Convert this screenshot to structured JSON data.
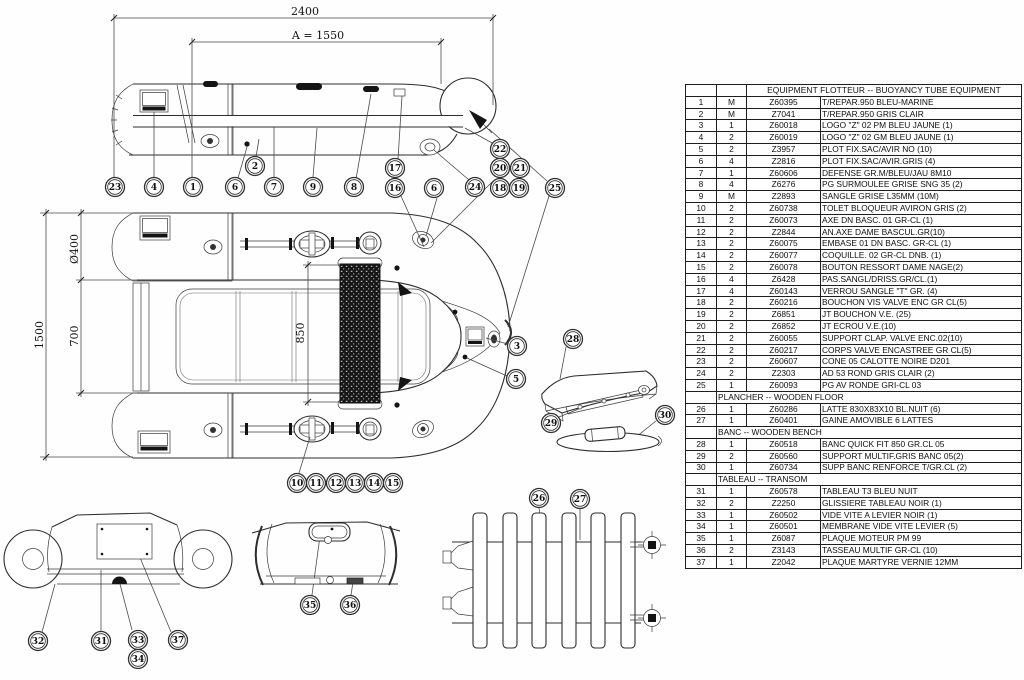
{
  "table": {
    "group_header": "EQUIPMENT FLOTTEUR -- BUOYANCY TUBE EQUIPMENT",
    "rows": [
      {
        "no": "1",
        "qty": "M",
        "ref": "Z60395",
        "desc": "T/REPAR.950 BLEU-MARINE"
      },
      {
        "no": "2",
        "qty": "M",
        "ref": "Z7041",
        "desc": "T/REPAR.950 GRIS CLAIR"
      },
      {
        "no": "3",
        "qty": "1",
        "ref": "Z60018",
        "desc": "LOGO \"Z\" 02 PM BLEU JAUNE (1)"
      },
      {
        "no": "4",
        "qty": "2",
        "ref": "Z60019",
        "desc": "LOGO \"Z\" 02 GM BLEU JAUNE (1)"
      },
      {
        "no": "5",
        "qty": "2",
        "ref": "Z3957",
        "desc": "PLOT FIX.SAC/AVIR NO (10)"
      },
      {
        "no": "6",
        "qty": "4",
        "ref": "Z2816",
        "desc": "PLOT FIX.SAC/AVIR.GRIS (4)"
      },
      {
        "no": "7",
        "qty": "1",
        "ref": "Z60606",
        "desc": "DEFENSE GR.M/BLEU/JAU 8M10"
      },
      {
        "no": "8",
        "qty": "4",
        "ref": "Z6276",
        "desc": "PG SURMOULEE GRISE SNG 35 (2)"
      },
      {
        "no": "9",
        "qty": "M",
        "ref": "Z2893",
        "desc": "SANGLE GRISE L35MM (10M)"
      },
      {
        "no": "10",
        "qty": "2",
        "ref": "Z60738",
        "desc": "TOLET BLOQUEUR AVIRON GRIS (2)"
      },
      {
        "no": "11",
        "qty": "2",
        "ref": "Z60073",
        "desc": "AXE DN BASC. 01 GR-CL (1)"
      },
      {
        "no": "12",
        "qty": "2",
        "ref": "Z2844",
        "desc": "AN.AXE DAME BASCUL.GR(10)"
      },
      {
        "no": "13",
        "qty": "2",
        "ref": "Z60075",
        "desc": "EMBASE 01 DN BASC. GR-CL (1)"
      },
      {
        "no": "14",
        "qty": "2",
        "ref": "Z60077",
        "desc": "COQUILLE. 02 GR-CL DNB. (1)"
      },
      {
        "no": "15",
        "qty": "2",
        "ref": "Z60078",
        "desc": "BOUTON RESSORT DAME NAGE(2)"
      },
      {
        "no": "16",
        "qty": "4",
        "ref": "Z6428",
        "desc": "PAS.SANGL/DRISS.GR/CL.(1)"
      },
      {
        "no": "17",
        "qty": "4",
        "ref": "Z60143",
        "desc": "VERROU SANGLE \"T\" GR. (4)"
      },
      {
        "no": "18",
        "qty": "2",
        "ref": "Z60216",
        "desc": "BOUCHON VIS VALVE ENC GR CL(5)"
      },
      {
        "no": "19",
        "qty": "2",
        "ref": "Z6851",
        "desc": "JT BOUCHON V.E. (25)"
      },
      {
        "no": "20",
        "qty": "2",
        "ref": "Z6852",
        "desc": "JT ECROU V.E.(10)"
      },
      {
        "no": "21",
        "qty": "2",
        "ref": "Z60055",
        "desc": "SUPPORT CLAP. VALVE ENC.02(10)"
      },
      {
        "no": "22",
        "qty": "2",
        "ref": "Z60217",
        "desc": "CORPS VALVE ENCASTREE GR CL(5)"
      },
      {
        "no": "23",
        "qty": "2",
        "ref": "Z60607",
        "desc": "CONE 05 CALOTTE NOIRE D201"
      },
      {
        "no": "24",
        "qty": "2",
        "ref": "Z2303",
        "desc": "AD 53 ROND GRIS CLAIR (2)"
      },
      {
        "no": "25",
        "qty": "1",
        "ref": "Z60093",
        "desc": "PG AV RONDE GRI-CL 03"
      },
      {
        "section": "PLANCHER -- WOODEN FLOOR"
      },
      {
        "no": "26",
        "qty": "1",
        "ref": "Z60286",
        "desc": "LATTE 830X83X10 BL.NUIT (6)"
      },
      {
        "no": "27",
        "qty": "1",
        "ref": "Z60401",
        "desc": "GAINE AMOVIBLE 6 LATTES"
      },
      {
        "section": "BANC -- WOODEN BENCH"
      },
      {
        "no": "28",
        "qty": "1",
        "ref": "Z60518",
        "desc": "BANC QUICK FIT 850 GR.CL 05"
      },
      {
        "no": "29",
        "qty": "2",
        "ref": "Z60560",
        "desc": "SUPPORT MULTIF.GRIS BANC 05(2)"
      },
      {
        "no": "30",
        "qty": "1",
        "ref": "Z60734",
        "desc": "SUPP BANC RENFORCE T/GR.CL (2)"
      },
      {
        "section": "TABLEAU -- TRANSOM"
      },
      {
        "no": "31",
        "qty": "1",
        "ref": "Z60578",
        "desc": "TABLEAU T3 BLEU NUIT"
      },
      {
        "no": "32",
        "qty": "2",
        "ref": "Z2250",
        "desc": "GLISSIERE TABLEAU NOIR (1)"
      },
      {
        "no": "33",
        "qty": "1",
        "ref": "Z60502",
        "desc": "VIDE VITE A LEVIER NOIR (1)"
      },
      {
        "no": "34",
        "qty": "1",
        "ref": "Z60501",
        "desc": "MEMBRANE VIDE VITE LEVIER (5)"
      },
      {
        "no": "35",
        "qty": "1",
        "ref": "Z6087",
        "desc": "PLAQUE MOTEUR PM 99"
      },
      {
        "no": "36",
        "qty": "2",
        "ref": "Z3143",
        "desc": "TASSEAU MULTIF GR-CL (10)"
      },
      {
        "no": "37",
        "qty": "1",
        "ref": "Z2042",
        "desc": "PLAQUE MARTYRE VERNIE 12MM"
      }
    ]
  },
  "dimensions": [
    {
      "label": "2400",
      "x": 305,
      "y": 15,
      "rotate": false
    },
    {
      "label": "A = 1550",
      "x": 318,
      "y": 39,
      "rotate": false
    },
    {
      "label": "1500",
      "x": 43,
      "y": 335,
      "rotate": true
    },
    {
      "label": "Ø400",
      "x": 78,
      "y": 249,
      "rotate": true
    },
    {
      "label": "700",
      "x": 78,
      "y": 336,
      "rotate": true
    },
    {
      "label": "850",
      "x": 304,
      "y": 333,
      "rotate": true
    }
  ],
  "callouts": [
    {
      "n": "23",
      "x": 115,
      "y": 187
    },
    {
      "n": "4",
      "x": 154,
      "y": 187
    },
    {
      "n": "1",
      "x": 193,
      "y": 187
    },
    {
      "n": "6",
      "x": 235,
      "y": 187
    },
    {
      "n": "2",
      "x": 255,
      "y": 166
    },
    {
      "n": "7",
      "x": 274,
      "y": 187
    },
    {
      "n": "9",
      "x": 313,
      "y": 187
    },
    {
      "n": "8",
      "x": 354,
      "y": 187
    },
    {
      "n": "17",
      "x": 395,
      "y": 168
    },
    {
      "n": "16",
      "x": 395,
      "y": 188
    },
    {
      "n": "6",
      "x": 434,
      "y": 188
    },
    {
      "n": "24",
      "x": 475,
      "y": 187
    },
    {
      "n": "22",
      "x": 500,
      "y": 149
    },
    {
      "n": "20",
      "x": 500,
      "y": 168
    },
    {
      "n": "21",
      "x": 520,
      "y": 168
    },
    {
      "n": "18",
      "x": 500,
      "y": 188
    },
    {
      "n": "19",
      "x": 519,
      "y": 188
    },
    {
      "n": "25",
      "x": 555,
      "y": 188
    },
    {
      "n": "3",
      "x": 517,
      "y": 346
    },
    {
      "n": "5",
      "x": 516,
      "y": 379
    },
    {
      "n": "28",
      "x": 573,
      "y": 339
    },
    {
      "n": "29",
      "x": 551,
      "y": 423
    },
    {
      "n": "30",
      "x": 665,
      "y": 415
    },
    {
      "n": "10",
      "x": 297,
      "y": 483
    },
    {
      "n": "11",
      "x": 316,
      "y": 483
    },
    {
      "n": "12",
      "x": 336,
      "y": 483
    },
    {
      "n": "13",
      "x": 355,
      "y": 483
    },
    {
      "n": "14",
      "x": 374,
      "y": 483
    },
    {
      "n": "15",
      "x": 393,
      "y": 483
    },
    {
      "n": "26",
      "x": 539,
      "y": 498
    },
    {
      "n": "27",
      "x": 580,
      "y": 499
    },
    {
      "n": "35",
      "x": 310,
      "y": 605
    },
    {
      "n": "36",
      "x": 350,
      "y": 605
    },
    {
      "n": "32",
      "x": 38,
      "y": 641
    },
    {
      "n": "31",
      "x": 101,
      "y": 641
    },
    {
      "n": "33",
      "x": 138,
      "y": 640
    },
    {
      "n": "34",
      "x": 138,
      "y": 659
    },
    {
      "n": "37",
      "x": 178,
      "y": 640
    }
  ]
}
